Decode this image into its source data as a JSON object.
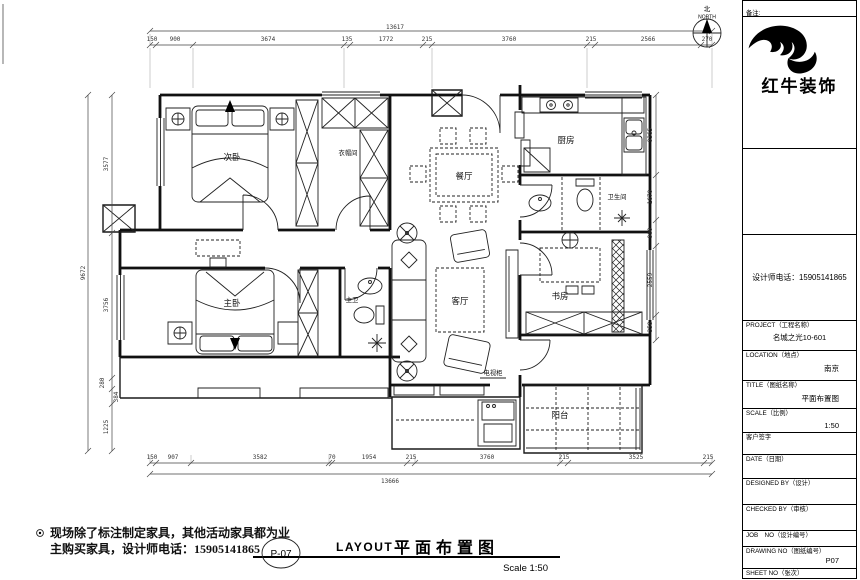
{
  "annotations": {
    "note_line1": "现场除了标注制定家具，其他活动家具都为业",
    "note_line2": "主购买家具，设计师电话：15905141865",
    "sheet_circle": "P-07",
    "title_en": "LAYOUT",
    "title_cn": "平面布置图",
    "scale_text": "Scale  1:50"
  },
  "compass": {
    "north_char": "北",
    "north_word": "NORTH"
  },
  "rooms": {
    "bedroom2": "次卧",
    "cloakroom": "衣帽间",
    "kitchen": "厨房",
    "dining": "餐厅",
    "bathroom": "卫生间",
    "study": "书房",
    "living": "客厅",
    "master": "主卧",
    "master_bath": "主卫",
    "balcony": "阳台",
    "tv_cabinet": "电视柜"
  },
  "dims": {
    "top_total": "13617",
    "top": [
      "150",
      "900",
      "3674",
      "135",
      "1772",
      "215",
      "3760",
      "215",
      "2566",
      "270"
    ],
    "bottom": [
      "150",
      "907",
      "3582",
      "70",
      "1954",
      "215",
      "3760",
      "215",
      "3525",
      "215"
    ],
    "bottom_total": "13666",
    "left_total": "9672",
    "left": [
      "3577",
      "3756",
      "280",
      "384",
      "1225"
    ],
    "right": [
      "9365",
      "1670",
      "900",
      "2559",
      "358"
    ]
  },
  "titleblock": {
    "remark_label": "备注:",
    "brand": "红牛装饰",
    "phone": "设计师电话：15905141865",
    "project_label": "PROJECT（工程名称）",
    "project_value": "名城之光10-601",
    "location_label": "LOCATION（地点）",
    "location_value": "南京",
    "title_label": "TITLE（图纸名称）",
    "title_value": "平面布置图",
    "scale_label": "SCALE（比例）",
    "scale_value": "1:50",
    "sign_label": "客户签字",
    "date_label": "DATE（日期）",
    "designed_label": "DESIGNED BY（设计）",
    "checked_label": "CHECKED BY（审核）",
    "job_label": "JOB　NO（设计编号）",
    "drawing_label": "DRAWING NO（图纸编号）",
    "drawing_value": "P07",
    "sheet_label": "SHEET NO（张次）"
  }
}
